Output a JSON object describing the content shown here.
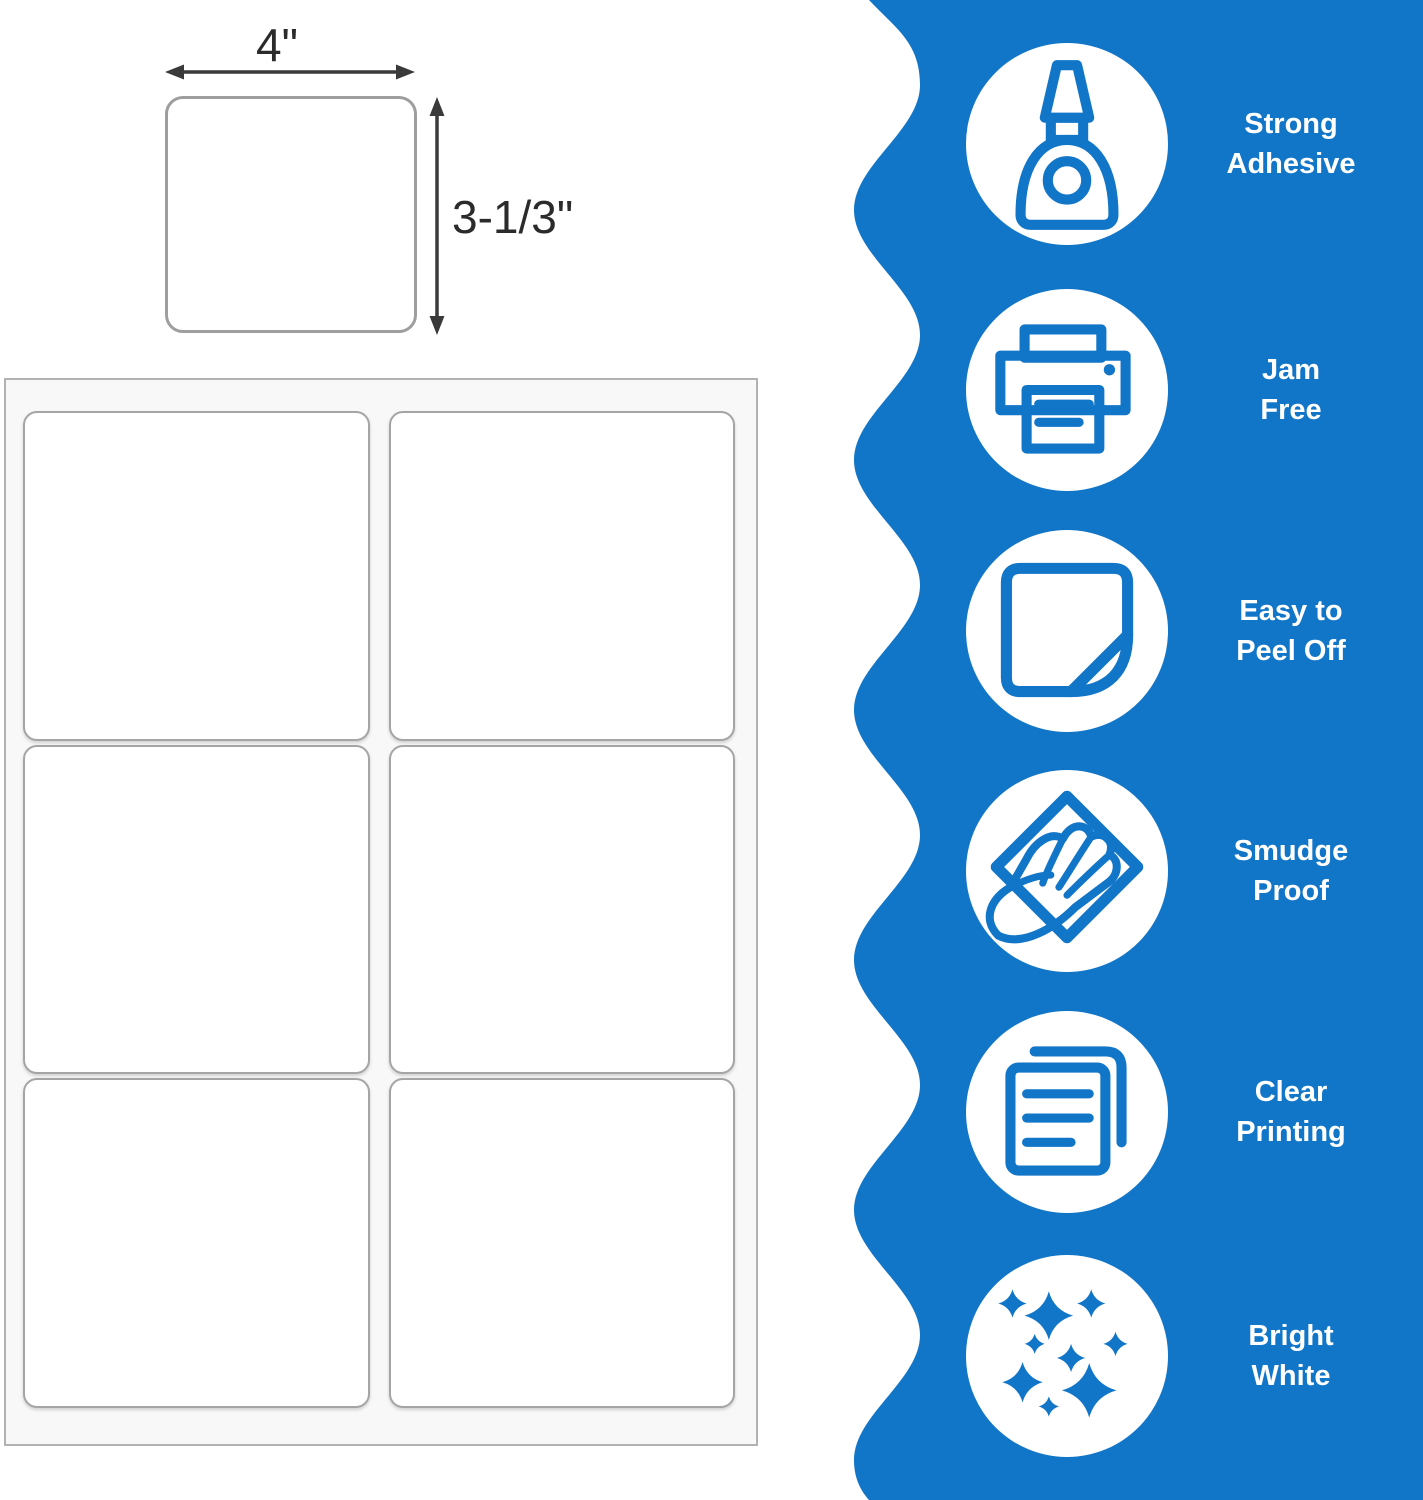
{
  "colors": {
    "accent": "#1175C8",
    "arrow_dark": "#3A3A3A"
  },
  "label_diagram": {
    "width_text": "4\"",
    "height_text": "3-1/3\""
  },
  "sheet": {
    "rows": 3,
    "columns": 2
  },
  "features": [
    {
      "icon": "glue-bottle-icon",
      "lines": [
        "Strong",
        "Adhesive"
      ]
    },
    {
      "icon": "printer-icon",
      "lines": [
        "Jam",
        "Free"
      ]
    },
    {
      "icon": "sticker-peel-icon",
      "lines": [
        "Easy to",
        "Peel Off"
      ]
    },
    {
      "icon": "hand-smudge-icon",
      "lines": [
        "Smudge",
        "Proof"
      ]
    },
    {
      "icon": "documents-icon",
      "lines": [
        "Clear",
        "Printing"
      ]
    },
    {
      "icon": "sparkles-icon",
      "lines": [
        "Bright",
        "White"
      ]
    }
  ]
}
